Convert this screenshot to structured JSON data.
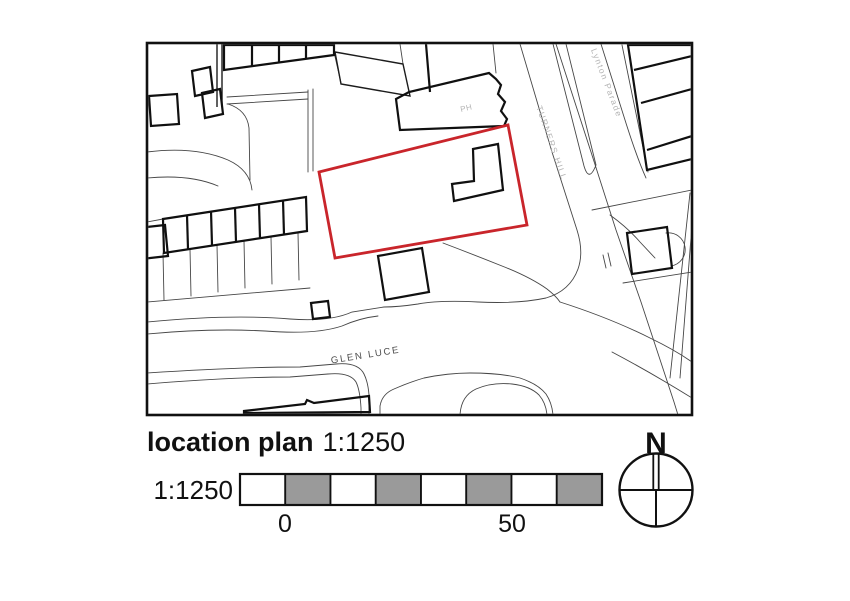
{
  "colors": {
    "site_outline": "#c9252b",
    "scale_segment_gray": "#9a9a9a",
    "map_label_gray": "#b5b5b5",
    "street_label_dark": "#4d4d4d"
  },
  "map": {
    "labels": {
      "pub": "PH",
      "turners_hill": "TURNERS HILL",
      "lynton_parade": "Lynton Parade",
      "glen_luce": "GLEN LUCE"
    }
  },
  "footer": {
    "title_bold": "location plan",
    "title_scale": "1:1250",
    "scalebar_label": "1:1250",
    "scalebar_tick_zero": "0",
    "scalebar_tick_fifty": "50",
    "north_label": "N"
  }
}
